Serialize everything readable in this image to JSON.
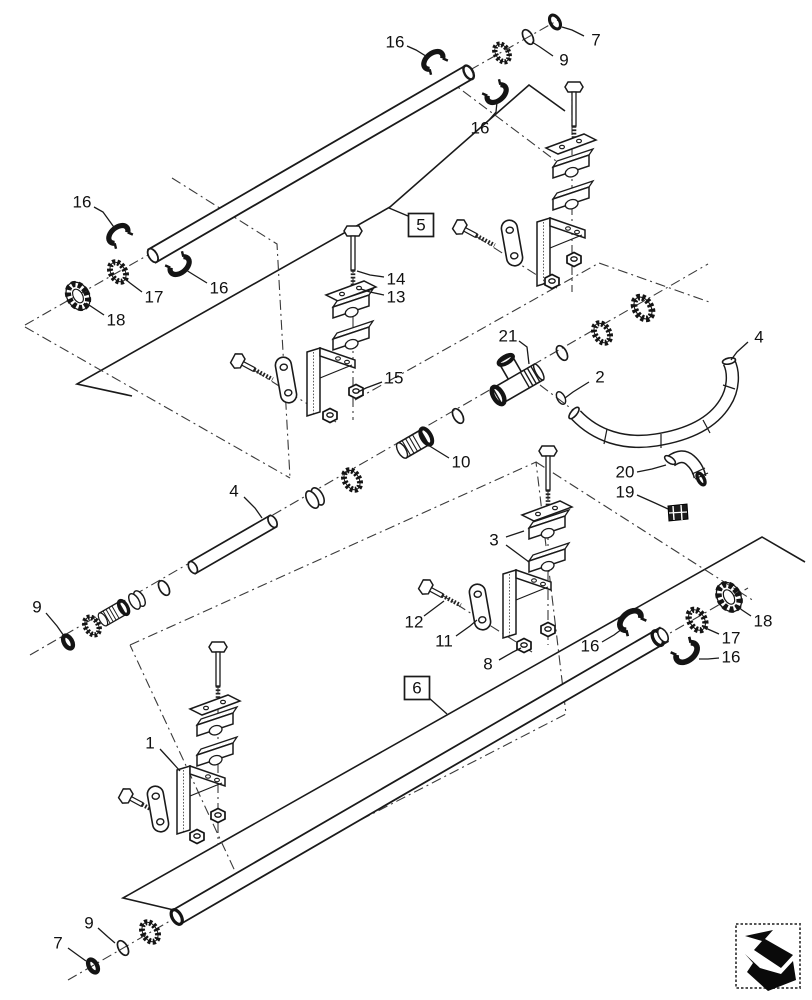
{
  "figure": {
    "type": "exploded-parts-diagram",
    "width": 812,
    "height": 1000,
    "colors": {
      "background": "#ffffff",
      "line": "#1a1a1a",
      "dashdot": "#3a3a3a",
      "part_black": "#141414",
      "fill": "#ffffff"
    }
  },
  "nav_icon": {
    "name": "previous-figure-arrow"
  },
  "callouts": [
    {
      "label": "16",
      "x": 82,
      "y": 202,
      "boxed": false,
      "leaders": [
        [
          [
            94,
            207
          ],
          [
            103,
            212
          ],
          [
            116,
            230
          ]
        ]
      ]
    },
    {
      "label": "16",
      "x": 395,
      "y": 42,
      "boxed": false,
      "leaders": [
        [
          [
            407,
            46
          ],
          [
            416,
            50
          ],
          [
            429,
            58
          ]
        ]
      ]
    },
    {
      "label": "7",
      "x": 596,
      "y": 40,
      "boxed": false,
      "leaders": [
        [
          [
            584,
            36
          ],
          [
            572,
            30
          ],
          [
            562,
            27
          ]
        ]
      ]
    },
    {
      "label": "9",
      "x": 564,
      "y": 60,
      "boxed": false,
      "leaders": [
        [
          [
            553,
            56
          ],
          [
            540,
            47
          ],
          [
            532,
            42
          ]
        ]
      ]
    },
    {
      "label": "16",
      "x": 480,
      "y": 128,
      "boxed": false,
      "leaders": [
        [
          [
            489,
            120
          ],
          [
            496,
            112
          ],
          [
            497,
            102
          ]
        ]
      ]
    },
    {
      "label": "17",
      "x": 154,
      "y": 297,
      "boxed": false,
      "leaders": [
        [
          [
            142,
            292
          ],
          [
            130,
            283
          ],
          [
            124,
            278
          ]
        ]
      ]
    },
    {
      "label": "16",
      "x": 219,
      "y": 288,
      "boxed": false,
      "leaders": [
        [
          [
            207,
            283
          ],
          [
            194,
            275
          ],
          [
            186,
            270
          ]
        ]
      ]
    },
    {
      "label": "18",
      "x": 116,
      "y": 320,
      "boxed": false,
      "leaders": [
        [
          [
            104,
            315
          ],
          [
            92,
            307
          ],
          [
            86,
            303
          ]
        ]
      ]
    },
    {
      "label": "14",
      "x": 396,
      "y": 279,
      "boxed": false,
      "leaders": [
        [
          [
            384,
            277
          ],
          [
            370,
            275
          ],
          [
            357,
            271
          ]
        ]
      ]
    },
    {
      "label": "13",
      "x": 396,
      "y": 297,
      "boxed": false,
      "leaders": [
        [
          [
            384,
            295
          ],
          [
            370,
            292
          ],
          [
            361,
            289
          ]
        ]
      ]
    },
    {
      "label": "15",
      "x": 394,
      "y": 378,
      "boxed": false,
      "leaders": [
        [
          [
            382,
            382
          ],
          [
            366,
            388
          ],
          [
            358,
            392
          ]
        ]
      ]
    },
    {
      "label": "5",
      "x": 421,
      "y": 225,
      "boxed": true,
      "leaders": [
        [
          [
            408,
            216
          ],
          [
            389,
            208
          ]
        ]
      ]
    },
    {
      "label": "21",
      "x": 508,
      "y": 336,
      "boxed": false,
      "leaders": [
        [
          [
            519,
            341
          ],
          [
            527,
            347
          ],
          [
            529,
            364
          ]
        ]
      ]
    },
    {
      "label": "2",
      "x": 600,
      "y": 377,
      "boxed": false,
      "leaders": [
        [
          [
            589,
            382
          ],
          [
            573,
            392
          ],
          [
            565,
            398
          ]
        ]
      ]
    },
    {
      "label": "4",
      "x": 759,
      "y": 337,
      "boxed": false,
      "leaders": [
        [
          [
            748,
            342
          ],
          [
            737,
            352
          ],
          [
            731,
            360
          ]
        ]
      ]
    },
    {
      "label": "10",
      "x": 461,
      "y": 462,
      "boxed": false,
      "leaders": [
        [
          [
            449,
            458
          ],
          [
            436,
            450
          ],
          [
            428,
            445
          ]
        ]
      ]
    },
    {
      "label": "20",
      "x": 625,
      "y": 472,
      "boxed": false,
      "leaders": [
        [
          [
            637,
            472
          ],
          [
            652,
            469
          ],
          [
            666,
            465
          ]
        ]
      ]
    },
    {
      "label": "19",
      "x": 625,
      "y": 492,
      "boxed": false,
      "leaders": [
        [
          [
            637,
            495
          ],
          [
            655,
            503
          ],
          [
            668,
            509
          ]
        ]
      ]
    },
    {
      "label": "4",
      "x": 234,
      "y": 491,
      "boxed": false,
      "leaders": [
        [
          [
            244,
            497
          ],
          [
            255,
            508
          ],
          [
            262,
            518
          ]
        ]
      ]
    },
    {
      "label": "9",
      "x": 37,
      "y": 607,
      "boxed": false,
      "leaders": [
        [
          [
            46,
            613
          ],
          [
            57,
            626
          ],
          [
            64,
            636
          ]
        ]
      ]
    },
    {
      "label": "3",
      "x": 494,
      "y": 540,
      "boxed": false,
      "leaders": [
        [
          [
            506,
            537
          ],
          [
            524,
            531
          ]
        ],
        [
          [
            506,
            545
          ],
          [
            529,
            562
          ]
        ]
      ]
    },
    {
      "label": "12",
      "x": 414,
      "y": 622,
      "boxed": false,
      "leaders": [
        [
          [
            424,
            616
          ],
          [
            436,
            607
          ],
          [
            444,
            601
          ]
        ]
      ]
    },
    {
      "label": "11",
      "x": 444,
      "y": 641,
      "boxed": false,
      "leaders": [
        [
          [
            456,
            636
          ],
          [
            470,
            626
          ],
          [
            477,
            620
          ]
        ]
      ]
    },
    {
      "label": "8",
      "x": 488,
      "y": 664,
      "boxed": false,
      "leaders": [
        [
          [
            499,
            660
          ],
          [
            513,
            652
          ],
          [
            521,
            648
          ]
        ]
      ]
    },
    {
      "label": "6",
      "x": 417,
      "y": 688,
      "boxed": true,
      "leaders": [
        [
          [
            429,
            698
          ],
          [
            447,
            714
          ]
        ]
      ]
    },
    {
      "label": "16",
      "x": 590,
      "y": 646,
      "boxed": false,
      "leaders": [
        [
          [
            602,
            642
          ],
          [
            614,
            635
          ],
          [
            622,
            629
          ]
        ]
      ]
    },
    {
      "label": "16",
      "x": 731,
      "y": 657,
      "boxed": false,
      "leaders": [
        [
          [
            719,
            658
          ],
          [
            708,
            659
          ],
          [
            699,
            659
          ]
        ]
      ]
    },
    {
      "label": "17",
      "x": 731,
      "y": 638,
      "boxed": false,
      "leaders": [
        [
          [
            719,
            634
          ],
          [
            710,
            630
          ],
          [
            703,
            627
          ]
        ]
      ]
    },
    {
      "label": "18",
      "x": 763,
      "y": 621,
      "boxed": false,
      "leaders": [
        [
          [
            751,
            616
          ],
          [
            742,
            610
          ],
          [
            736,
            605
          ]
        ]
      ]
    },
    {
      "label": "1",
      "x": 150,
      "y": 743,
      "boxed": false,
      "leaders": [
        [
          [
            160,
            749
          ],
          [
            171,
            761
          ],
          [
            180,
            771
          ]
        ]
      ]
    },
    {
      "label": "9",
      "x": 89,
      "y": 923,
      "boxed": false,
      "leaders": [
        [
          [
            98,
            928
          ],
          [
            108,
            937
          ],
          [
            115,
            943
          ]
        ]
      ]
    },
    {
      "label": "7",
      "x": 58,
      "y": 943,
      "boxed": false,
      "leaders": [
        [
          [
            68,
            948
          ],
          [
            79,
            956
          ],
          [
            86,
            961
          ]
        ]
      ]
    }
  ]
}
